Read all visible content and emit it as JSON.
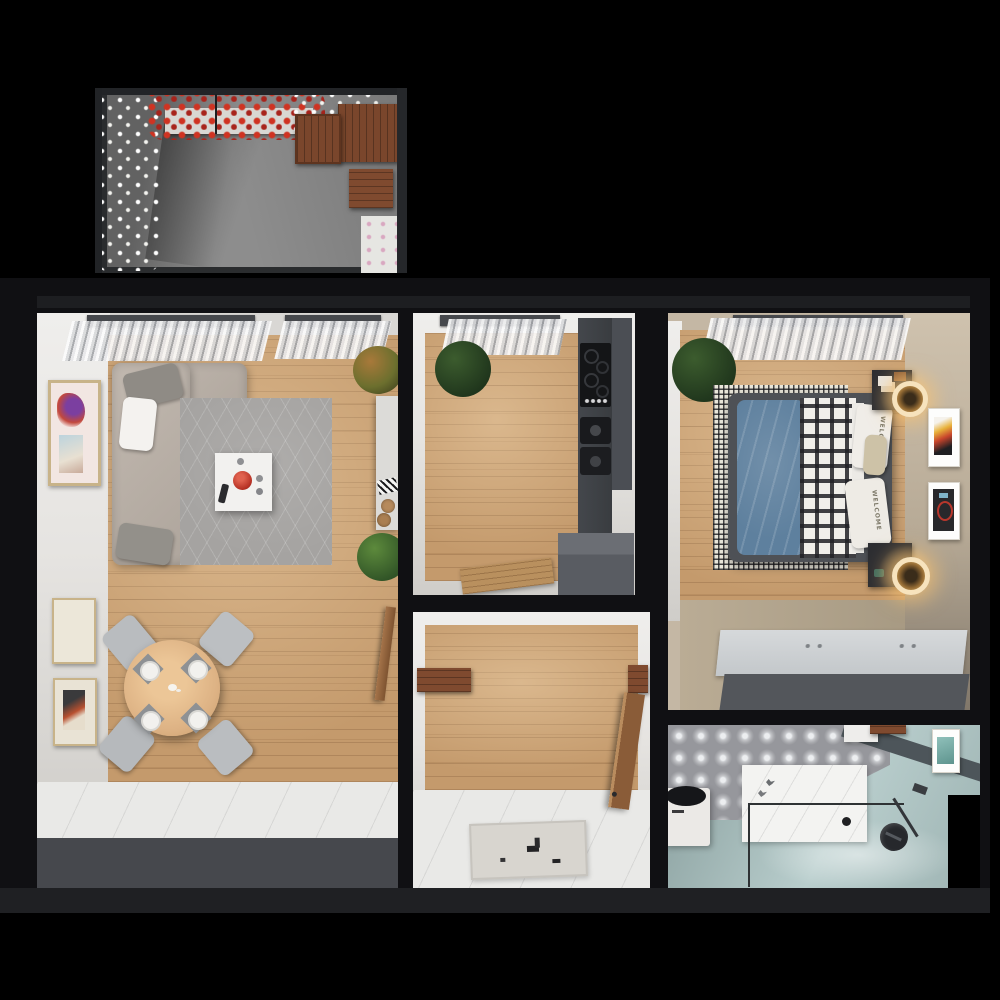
{
  "scene": {
    "kind": "top-down 3D render of a one-bedroom apartment floor plan with balcony terrace",
    "background": "#000000",
    "visible_text": "none except decorative pillow print"
  },
  "bedroom": {
    "pillow_print": "WELCOME"
  },
  "palette": {
    "background": "#000000",
    "structure_wall": "#101013",
    "wall_trim": "#222226",
    "white_wall": "#e9e7e4",
    "wood_floor": "#c49a6c",
    "white_floor": "#e9e9e7",
    "gray_band": "#47494e",
    "rug_gray": "#a5a3a1",
    "sofa_beige": "#b6ada4",
    "accent_red_bowl": "#c23b2c",
    "dining_wood": "#ddb284",
    "terrace_concrete": "#8d8d8d",
    "terrace_wood": "#7a462c",
    "flower_red": "#cf3322",
    "flower_white": "#ffffff",
    "kitchen_counter": "#3e4146",
    "bed_duvet_blue": "#5e809e",
    "bedroom_wall_beige": "#c4b7a4",
    "lamp_glow": "#f7d9a0",
    "bath_tile": "#96979c",
    "bath_teal_floor": "#a9bfbe",
    "platform_gray": "#54575c"
  },
  "rooms": {
    "terrace": [
      "pergola-frame",
      "red-flower-planter",
      "white-flower-planter",
      "wood-table",
      "wood-chair",
      "wood-bench",
      "grass-planter",
      "concrete-floor"
    ],
    "living_room": [
      "corner-sofa",
      "throw-pillows",
      "hex-pattern-rug",
      "coffee-table",
      "red-bowl",
      "remote-control",
      "wall-art",
      "dining-table",
      "dining-chairs",
      "place-settings",
      "console-desk",
      "cork-stools",
      "potted-plants",
      "curtains",
      "interior-door"
    ],
    "kitchen": [
      "counter-run",
      "cooktop",
      "sink",
      "tall-cabinet",
      "base-cabinet-island",
      "cutting-board",
      "potted-plant",
      "curtains"
    ],
    "hallway": [
      "entry-door",
      "wall-shelf",
      "door-mat"
    ],
    "bedroom": [
      "double-bed",
      "blue-duvet",
      "plaid-blanket",
      "welcome-pillows",
      "checkered-rug",
      "nightstands",
      "ring-lamps",
      "wall-posters",
      "potted-plant",
      "storage-platform",
      "curtains"
    ],
    "bathroom": [
      "patterned-tile-floor",
      "walk-in-shower",
      "glass-screen",
      "black-shower-set",
      "washing-machine",
      "vanity-shelf",
      "mirror"
    ]
  }
}
